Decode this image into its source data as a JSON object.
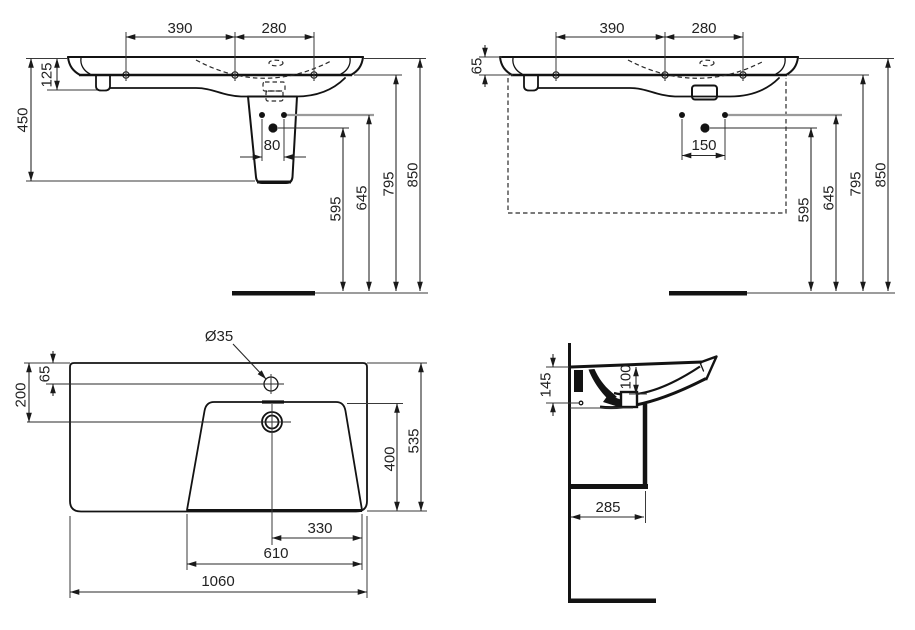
{
  "drawing": {
    "background": "#ffffff",
    "line_color": "#131313",
    "accent_gray": "#9a9a9a",
    "views": {
      "front_with_pedestal": {
        "dims": {
          "tap_span_left": "390",
          "tap_span_right": "280",
          "rim_height": "125",
          "total_unit_height": "450",
          "fixing_hole_spacing": "80",
          "drain_outlet_height": "595",
          "fixing_holes_height": "645",
          "basin_underside_height": "795",
          "rim_top_height": "850"
        }
      },
      "front_wall_hung": {
        "dims": {
          "tap_span_left": "390",
          "tap_span_right": "280",
          "rim_thickness": "65",
          "fixing_hole_spacing": "150",
          "drain_outlet_height": "595",
          "fixing_holes_height": "645",
          "basin_underside_height": "795",
          "rim_top_height": "850"
        }
      },
      "plan": {
        "dims": {
          "tap_hole_diameter": "Ø35",
          "tap_hole_offset": "65",
          "drain_offset": "200",
          "bowl_depth": "400",
          "overall_depth": "535",
          "drain_to_bowl_edge": "330",
          "bowl_width": "610",
          "overall_width": "1060"
        }
      },
      "side_section": {
        "dims": {
          "rear_height": "145",
          "bowl_inner_depth": "100",
          "trap_distance": "285"
        }
      }
    }
  }
}
